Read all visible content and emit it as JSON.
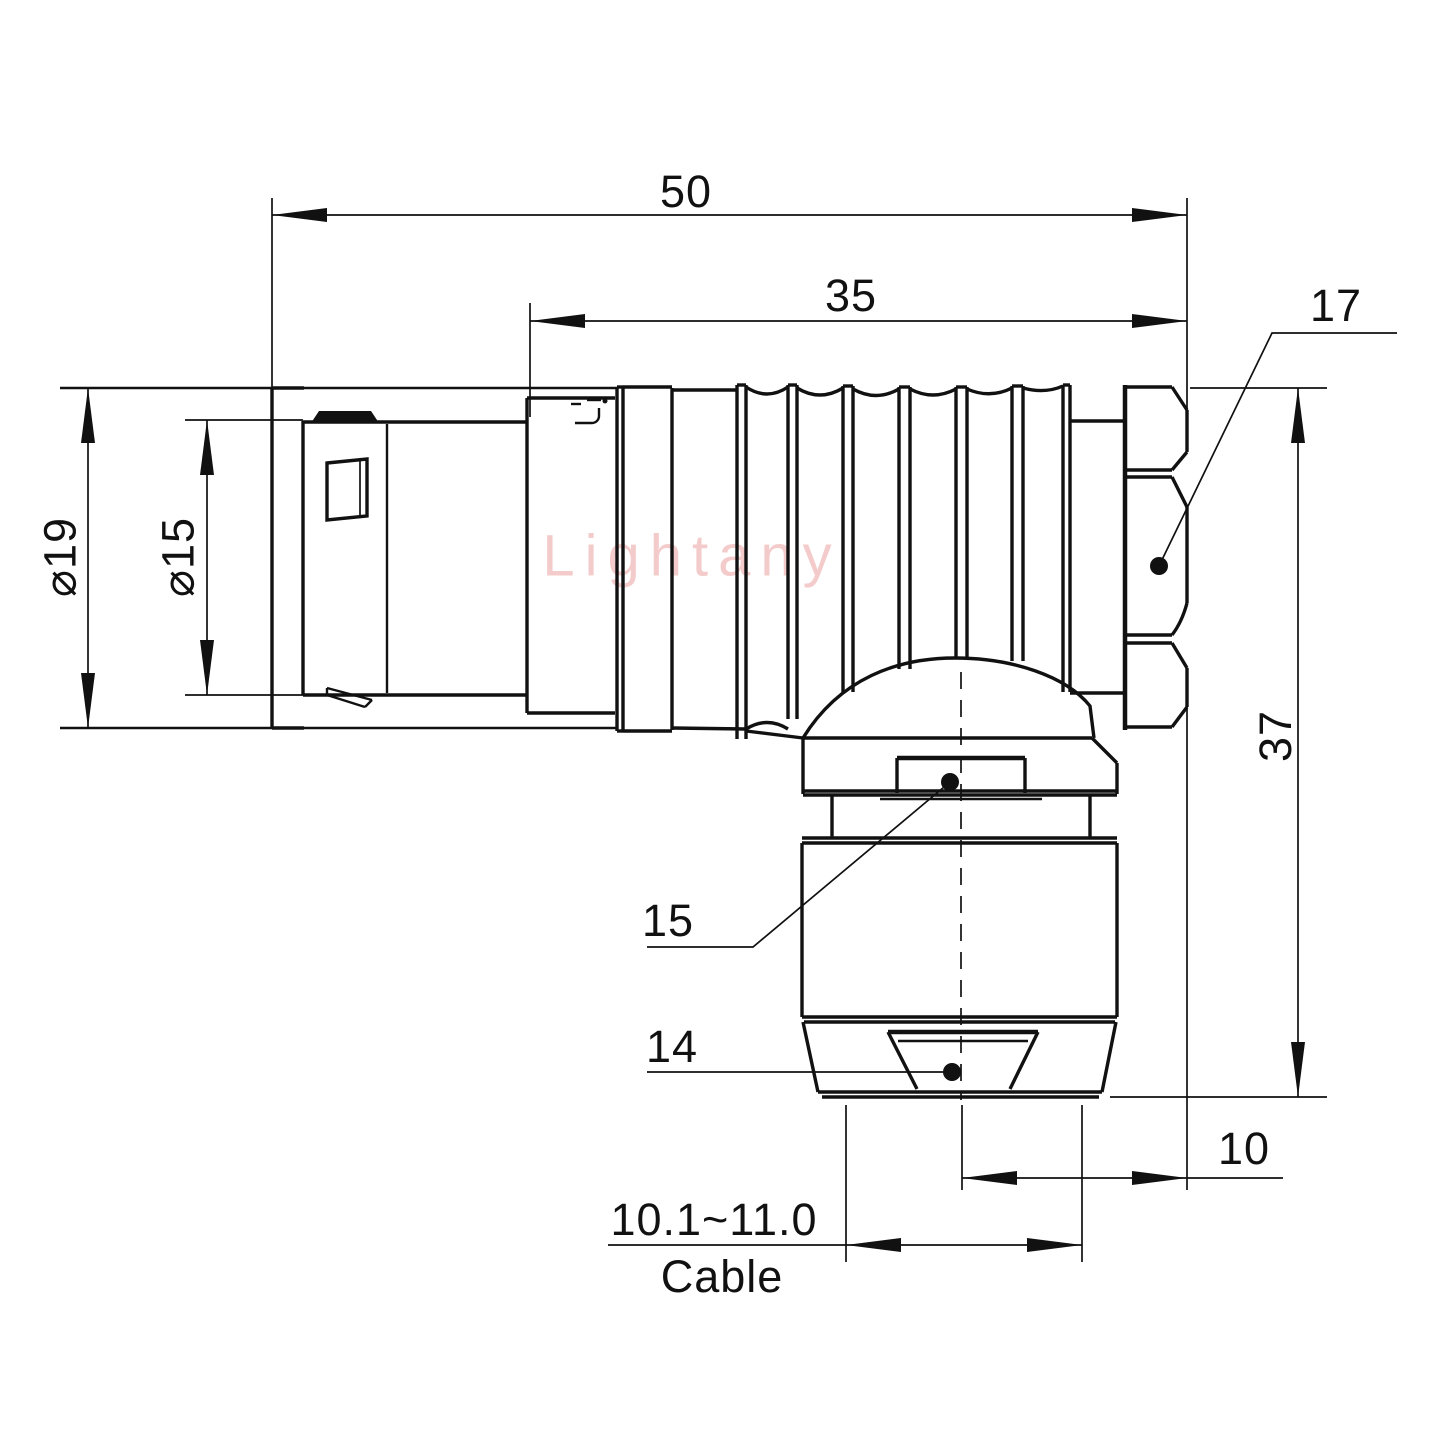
{
  "drawing": {
    "watermark": "Lightany",
    "dimensions": {
      "total_length": "50",
      "body_length": "35",
      "hex_flats": "17",
      "outer_diameter": "⌀19",
      "inner_diameter": "⌀15",
      "total_height": "37",
      "gland_flat": "15",
      "nose_flat": "14",
      "offset": "10",
      "cable_range": "10.1~11.0",
      "cable_word": "Cable"
    }
  }
}
